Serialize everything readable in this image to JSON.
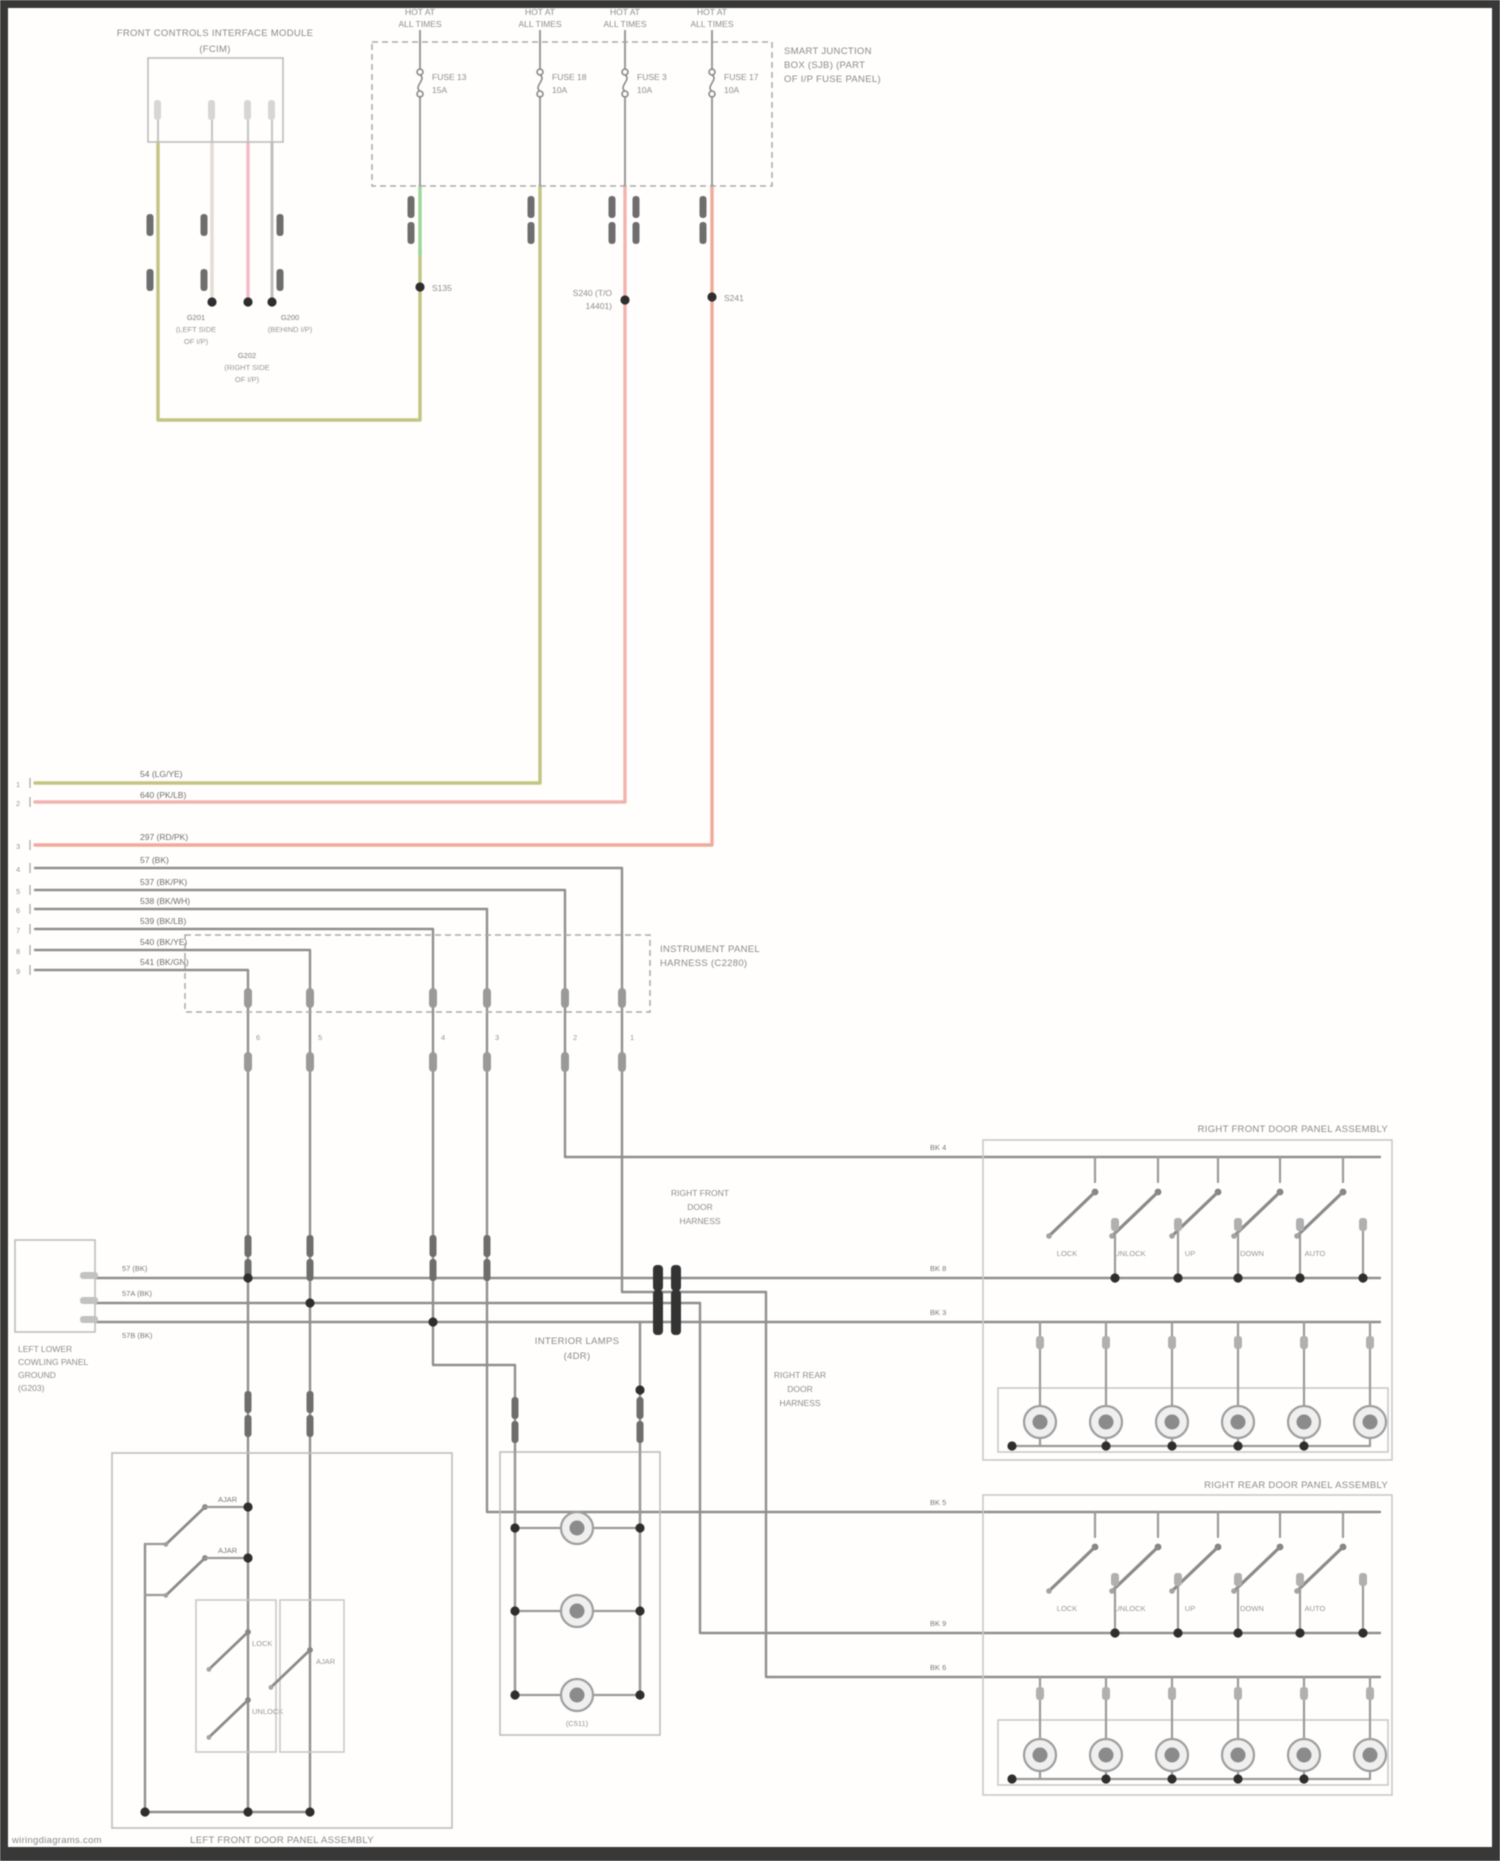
{
  "module": {
    "title": [
      "FRONT CONTROLS INTERFACE MODULE",
      "(FCIM)"
    ],
    "grounds": [
      {
        "lines": [
          "G201",
          "(LEFT SIDE",
          "OF I/P)"
        ]
      },
      {
        "lines": [
          "G202",
          "(RIGHT SIDE",
          "OF I/P)"
        ]
      },
      {
        "lines": [
          "G200",
          "(BEHIND I/P)"
        ]
      }
    ]
  },
  "fuse_box": {
    "hot_label": [
      "HOT AT",
      "ALL TIMES"
    ],
    "fuses": [
      {
        "name": "FUSE 13",
        "amps": "15A"
      },
      {
        "name": "FUSE 18",
        "amps": "10A"
      },
      {
        "name": "FUSE 3",
        "amps": "10A"
      },
      {
        "name": "FUSE 17",
        "amps": "10A"
      }
    ],
    "sjb": [
      "SMART JUNCTION",
      "BOX (SJB) (PART",
      "OF I/P FUSE PANEL)"
    ],
    "splice1": "S135",
    "splice3": [
      "S240 (T/O",
      "14401)"
    ],
    "splice4": "S241"
  },
  "left_wires": {
    "pins": [
      "1",
      "2",
      "3",
      "4",
      "5",
      "6",
      "7",
      "8",
      "9"
    ],
    "labels": [
      "54 (LG/YE)",
      "640 (PK/LB)",
      "297 (RD/PK)",
      "57 (BK)",
      "537 (BK/PK)",
      "538 (BK/WH)",
      "539 (BK/LB)",
      "540 (BK/YE)",
      "541 (BK/GN)"
    ]
  },
  "connector": {
    "label": [
      "INSTRUMENT PANEL",
      "HARNESS (C2280)"
    ],
    "pins": [
      "6",
      "5",
      "4",
      "3",
      "2",
      "1"
    ]
  },
  "ground_box": {
    "wire_labels": [
      "57 (BK)",
      "57A (BK)",
      "57B (BK)"
    ],
    "label": [
      "LEFT LOWER",
      "COWLING PANEL",
      "GROUND",
      "(G203)"
    ]
  },
  "lamp_box": {
    "title": [
      "INTERIOR LAMPS",
      "(4DR)"
    ],
    "bottom": "(C511)"
  },
  "left_door": {
    "label": "LEFT FRONT DOOR PANEL ASSEMBLY",
    "ajar_switch_1": "AJAR",
    "ajar_switch_2": "AJAR",
    "lock_switch": "LOCK",
    "unlock_switch": "UNLOCK",
    "ajar_switch_3": "AJAR"
  },
  "panels": [
    {
      "title": "RIGHT FRONT DOOR PANEL ASSEMBLY",
      "feeds": [
        "BK 4",
        "BK 8",
        "BK 3"
      ],
      "harness": [
        "RIGHT FRONT",
        "DOOR",
        "HARNESS"
      ],
      "switches": [
        "LOCK",
        "UNLOCK",
        "UP",
        "DOWN",
        "AUTO"
      ]
    },
    {
      "title": "RIGHT REAR DOOR PANEL ASSEMBLY",
      "feeds": [
        "BK 5",
        "BK 9",
        "BK 6"
      ],
      "harness": [
        "RIGHT REAR",
        "DOOR",
        "HARNESS"
      ],
      "switches": [
        "LOCK",
        "UNLOCK",
        "UP",
        "DOWN",
        "AUTO"
      ]
    }
  ],
  "watermark": "wiringdiagrams.com",
  "colors": {
    "wire_olive": "#c3c583",
    "wire_pink": "#f3b9c6",
    "wire_salmon": "#efab99",
    "wire_green": "#9ed69a",
    "wire_gray": "#8f8f8f",
    "frame": "#383838"
  }
}
